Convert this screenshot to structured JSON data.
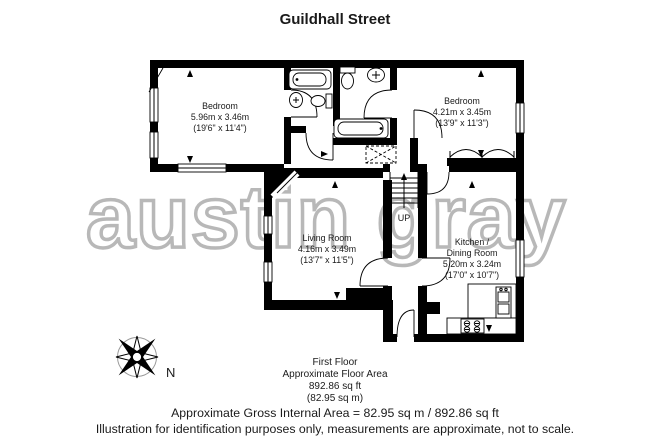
{
  "title": "Guildhall Street",
  "watermark": "austin gray",
  "compass": {
    "north_label": "N"
  },
  "plan": {
    "rooms": {
      "bedroom1": {
        "name": "Bedroom",
        "metric": "5.96m x 3.46m",
        "imperial": "(19'6\" x 11'4\")"
      },
      "bedroom2": {
        "name": "Bedroom",
        "metric": "4.21m x 3.45m",
        "imperial": "(13'9\" x 11'3\")"
      },
      "living_room": {
        "name": "Living Room",
        "metric": "4.16m x 3.49m",
        "imperial": "(13'7\" x 11'5\")"
      },
      "kitchen_dining": {
        "name_line1": "Kitchen /",
        "name_line2": "Dining Room",
        "metric": "5.20m x 3.24m",
        "imperial": "(17'0\" x 10'7\")"
      }
    },
    "stairs": {
      "label": "UP"
    }
  },
  "floor_summary": {
    "floor": "First Floor",
    "area_title": "Approximate Floor Area",
    "area_ft": "892.86 sq ft",
    "area_m": "(82.95 sq m)"
  },
  "footer": {
    "gross_area": "Approximate Gross Internal Area = 82.95 sq m / 892.86 sq ft",
    "disclaimer": "Illustration for identification purposes only, measurements are approximate, not to scale."
  },
  "colors": {
    "wall": "#000000",
    "watermark": "#b8b8b8",
    "text": "#1a1a1a",
    "background": "#ffffff"
  }
}
